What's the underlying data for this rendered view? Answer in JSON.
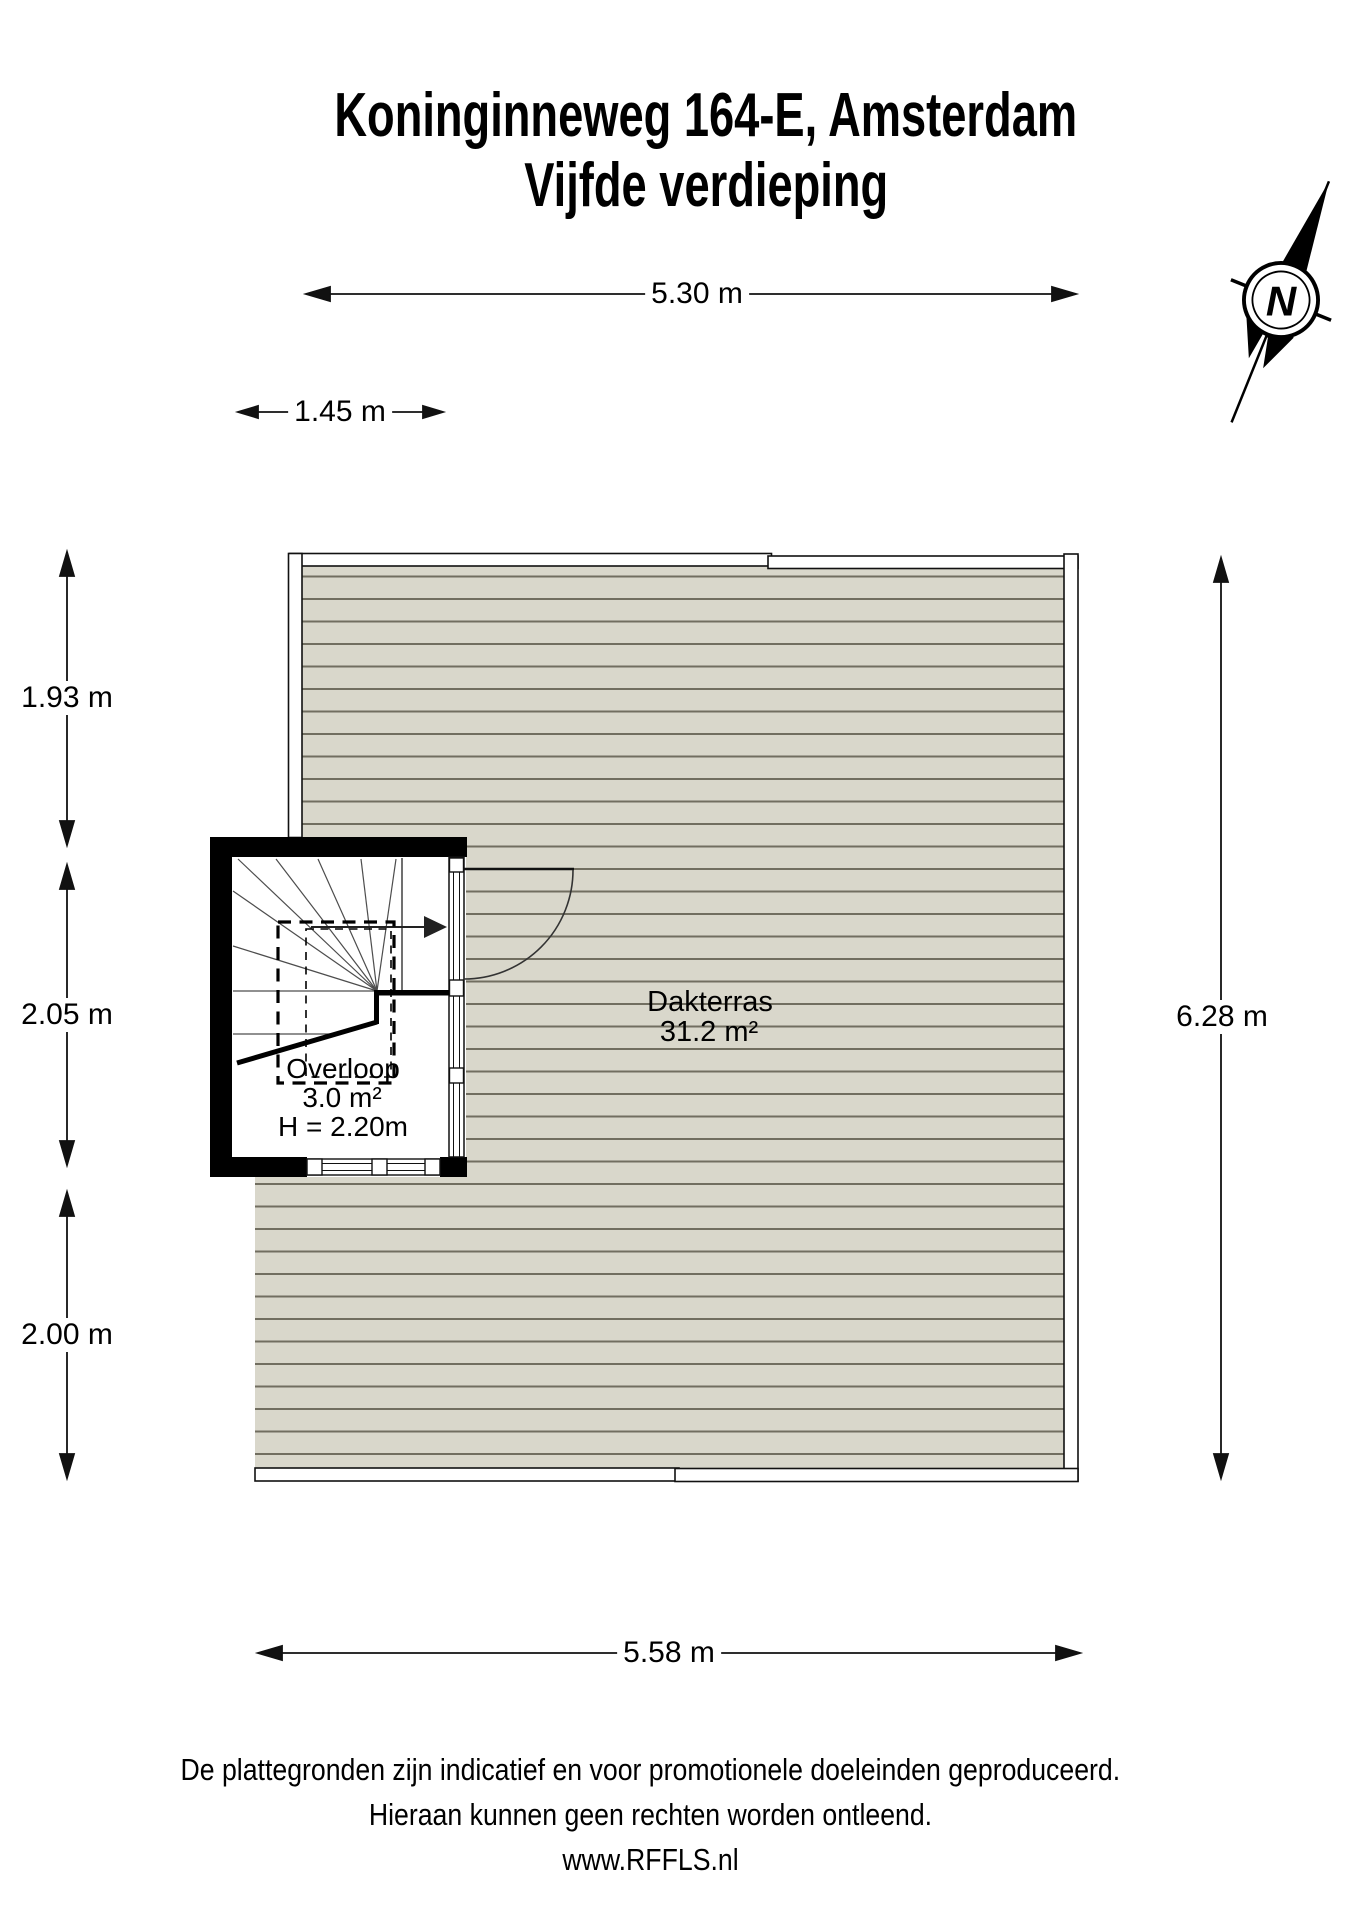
{
  "title": {
    "line1": "Koninginneweg 164-E, Amsterdam",
    "line2": "Vijfde verdieping"
  },
  "compass": {
    "label": "N"
  },
  "dimensions": {
    "top_overall": "5.30 m",
    "top_inner": "1.45 m",
    "left_upper": "1.93 m",
    "left_middle": "2.05 m",
    "left_lower": "2.00 m",
    "right_overall": "6.28 m",
    "bottom_overall": "5.58 m"
  },
  "rooms": {
    "terrace": {
      "name": "Dakterras",
      "area": "31.2 m²"
    },
    "landing": {
      "name": "Overloop",
      "area": "3.0 m²",
      "ceiling_height": "H = 2.20m"
    }
  },
  "footer": {
    "line1": "De plattegronden zijn indicatief en voor promotionele doeleinden geproduceerd.",
    "line2": "Hieraan kunnen geen rechten worden ontleend.",
    "line3": "www.RFFLS.nl"
  },
  "colors": {
    "deck_fill": "#d9d7cb",
    "deck_line": "#716e60",
    "wall": "#000000"
  }
}
